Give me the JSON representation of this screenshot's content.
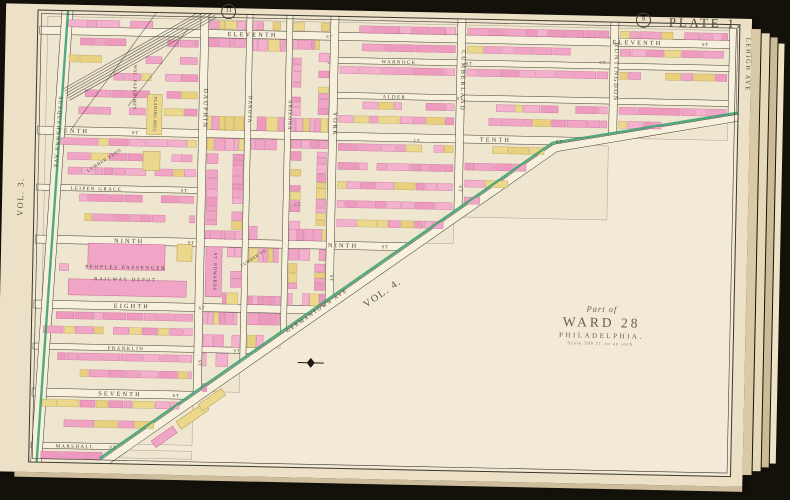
{
  "page": {
    "plate_title": "PLATE 1.",
    "volume_left": "VOL. 3.",
    "volume_right": "VOL. 4.",
    "join_circles": [
      {
        "label": "11"
      },
      {
        "label": "9"
      }
    ],
    "ward_block": {
      "part_of": "Part of",
      "ward": "WARD 28",
      "city": "PHILADELPHIA.",
      "scale": "Scale 300 ft. to an inch."
    }
  },
  "colors": {
    "paper": "#ece1c6",
    "map_bg": "#efe6cf",
    "blank_fill": "#f2ead7",
    "street_fill": "#f7f0dd",
    "line": "#3a362c",
    "ink": "#45402f",
    "block_outline": "#7a6f5c",
    "building_pinks": [
      "#f1a5c6",
      "#ee9abf",
      "#f4b1cd"
    ],
    "building_yellows": [
      "#ecd88d",
      "#e8d07e"
    ],
    "pink_stroke": "#c2699b",
    "yellow_stroke": "#b09c55",
    "green_line": "#41a173",
    "page_stack": [
      "#d9c9a6",
      "#e6d9ba",
      "#cbbb97",
      "#efe3c6"
    ]
  },
  "map": {
    "width": 702,
    "height": 452,
    "horizontal_streets": [
      {
        "name": "ELEVENTH",
        "suffix": "ST",
        "y": 20,
        "x1": 8,
        "x2": 700,
        "label_x": 215,
        "suffix_x": 292,
        "label2_x": 600,
        "suffix2_x": 668,
        "small": false
      },
      {
        "name": "WARNOCK",
        "suffix": "ST",
        "y": 44,
        "x1": 297,
        "x2": 700,
        "label_x": 362,
        "suffix_x": 432,
        "small": true
      },
      {
        "name": "ALDER",
        "suffix": "ST",
        "y": 79,
        "x1": 297,
        "x2": 700,
        "label_x": 358,
        "suffix_x": 424,
        "small": true
      },
      {
        "name": "TENTH",
        "suffix": "ST",
        "y": 120,
        "x1": 8,
        "x2": 556,
        "label_x": 38,
        "suffix_x": 100,
        "label2_x": 460,
        "suffix2_x": 524,
        "small": false
      },
      {
        "name": "LEIPER GRACE",
        "suffix": "ST",
        "y": 177,
        "x1": 8,
        "x2": 167,
        "label_x": 62,
        "suffix_x": 150,
        "small": true
      },
      {
        "name": "NINTH",
        "suffix": "ST",
        "y": 229,
        "x1": 8,
        "x2": 380,
        "label_x": 96,
        "suffix_x": 158,
        "label2_x": 310,
        "suffix2_x": 352,
        "small": false
      },
      {
        "name": "EIGHTH",
        "suffix": "ST",
        "y": 294,
        "x1": 8,
        "x2": 291,
        "label_x": 100,
        "suffix_x": 170,
        "small": false
      },
      {
        "name": "FRANKLIN",
        "suffix": "ST",
        "y": 336,
        "x1": 8,
        "x2": 233,
        "label_x": 95,
        "suffix_x": 206,
        "small": true
      },
      {
        "name": "SEVENTH",
        "suffix": "ST",
        "y": 382,
        "x1": 8,
        "x2": 170,
        "label_x": 90,
        "suffix_x": 146,
        "small": false
      },
      {
        "name": "MARSHALL",
        "suffix": "ST",
        "y": 435,
        "x1": 8,
        "x2": 97,
        "label_x": 46,
        "suffix_x": 84,
        "small": true
      }
    ],
    "vertical_streets": [
      {
        "name": "DAUPHIN",
        "suffix": "ST",
        "x": 167,
        "y1": 0,
        "y2": 384,
        "label_y": 95,
        "suffix_y": 350,
        "small": false
      },
      {
        "name": "DAKOTA",
        "suffix": "",
        "x": 212,
        "y1": 0,
        "y2": 351,
        "label_y": 95,
        "small": true
      },
      {
        "name": "ARIZONA",
        "suffix": "",
        "x": 252,
        "y1": 0,
        "y2": 322,
        "label_y": 100,
        "small": true
      },
      {
        "name": "YORK",
        "suffix": "ST",
        "x": 297,
        "y1": 0,
        "y2": 290,
        "label_y": 108,
        "suffix_y": 262,
        "small": false
      },
      {
        "name": "CUMBERLAND",
        "suffix": "ST",
        "x": 424,
        "y1": 0,
        "y2": 197,
        "label_y": 62,
        "suffix_y": 170,
        "small": false
      },
      {
        "name": "HUNTINGDON",
        "suffix": "ST",
        "x": 577,
        "y1": 0,
        "y2": 116,
        "label_y": 50,
        "small": false
      },
      {
        "name": "LEHIGH AVE",
        "suffix": "",
        "x": 696,
        "y1": 0,
        "y2": 94,
        "label_y": 40,
        "margin_label": true,
        "small": false
      }
    ],
    "left_avenue": {
      "name": "SUSQUEHANNA AVE",
      "x_top": 30,
      "x_bottom": 8,
      "label_x": 21,
      "label_y": 122
    },
    "diagonal_avenue": {
      "name": "GERMANTOWN AVE",
      "points": [
        [
          74,
          452
        ],
        [
          520,
          127
        ],
        [
          702,
          93
        ]
      ],
      "label_x": 286,
      "label_y": 296,
      "label_angle": -36
    },
    "vol4_label": {
      "x": 352,
      "y": 278,
      "angle": -36
    },
    "railroad": {
      "main": [
        [
          175,
          -2
        ],
        [
          30,
          84
        ]
      ],
      "tracks": 6,
      "spacing": 2.6,
      "spurs": [
        [
          [
            120,
            -2
          ],
          [
            36,
            118
          ]
        ],
        [
          [
            150,
            16
          ],
          [
            92,
            94
          ]
        ]
      ]
    },
    "compass": {
      "x": 280,
      "y": 347
    },
    "annotations": [
      {
        "text": "PEOPLES  PASSENGER",
        "x": 93,
        "y": 257,
        "size": 5,
        "ls": 1.8,
        "angle": 0
      },
      {
        "text": "RAILWAY  DEPOT",
        "x": 93,
        "y": 269,
        "size": 5,
        "ls": 1.8,
        "angle": 0
      },
      {
        "text": "ST. EDWARDS",
        "x": 181,
        "y": 258,
        "size": 4.6,
        "ls": 0.8,
        "angle": 90
      },
      {
        "text": "WAL. PAPER MFY.",
        "x": 97,
        "y": 76,
        "size": 4.6,
        "ls": 0.6,
        "angle": 90
      },
      {
        "text": "PLANING MILL",
        "x": 118,
        "y": 102,
        "size": 4.2,
        "ls": 0.5,
        "angle": 90
      },
      {
        "text": "LUMBER YARD",
        "x": 70,
        "y": 150,
        "size": 4.4,
        "ls": 0.8,
        "angle": -34
      },
      {
        "text": "LUMBER YD.",
        "x": 222,
        "y": 244,
        "size": 4.2,
        "ls": 0.6,
        "angle": -34
      },
      {
        "text": "CT.",
        "x": 264,
        "y": 190,
        "size": 4.2,
        "ls": 0.4,
        "angle": 0
      },
      {
        "text": "CT.",
        "x": 382,
        "y": 124,
        "size": 4.2,
        "ls": 0.4,
        "angle": 0
      },
      {
        "text": "CT.",
        "x": 566,
        "y": 42,
        "size": 4.2,
        "ls": 0.4,
        "angle": 0
      }
    ],
    "landmark_buildings": [
      {
        "x": 55,
        "y": 232,
        "w": 77,
        "h": 26,
        "c": "pink",
        "angle": 0
      },
      {
        "x": 36,
        "y": 268,
        "w": 118,
        "h": 16,
        "c": "pink",
        "angle": 0
      },
      {
        "x": 144,
        "y": 231,
        "w": 15,
        "h": 17,
        "c": "yellow",
        "angle": 0
      },
      {
        "x": 173,
        "y": 233,
        "w": 16,
        "h": 50,
        "c": "pink",
        "angle": 0
      },
      {
        "x": 111,
        "y": 82,
        "w": 15,
        "h": 40,
        "c": "yellow",
        "angle": 0
      },
      {
        "x": 108,
        "y": 139,
        "w": 17,
        "h": 19,
        "c": "yellow",
        "angle": 0
      },
      {
        "x": 146,
        "y": 398,
        "w": 34,
        "h": 9,
        "c": "yellow",
        "angle": -36
      },
      {
        "x": 122,
        "y": 420,
        "w": 26,
        "h": 8,
        "c": "pink",
        "angle": -36
      },
      {
        "x": 168,
        "y": 382,
        "w": 28,
        "h": 8,
        "c": "yellow",
        "angle": -36
      }
    ]
  }
}
